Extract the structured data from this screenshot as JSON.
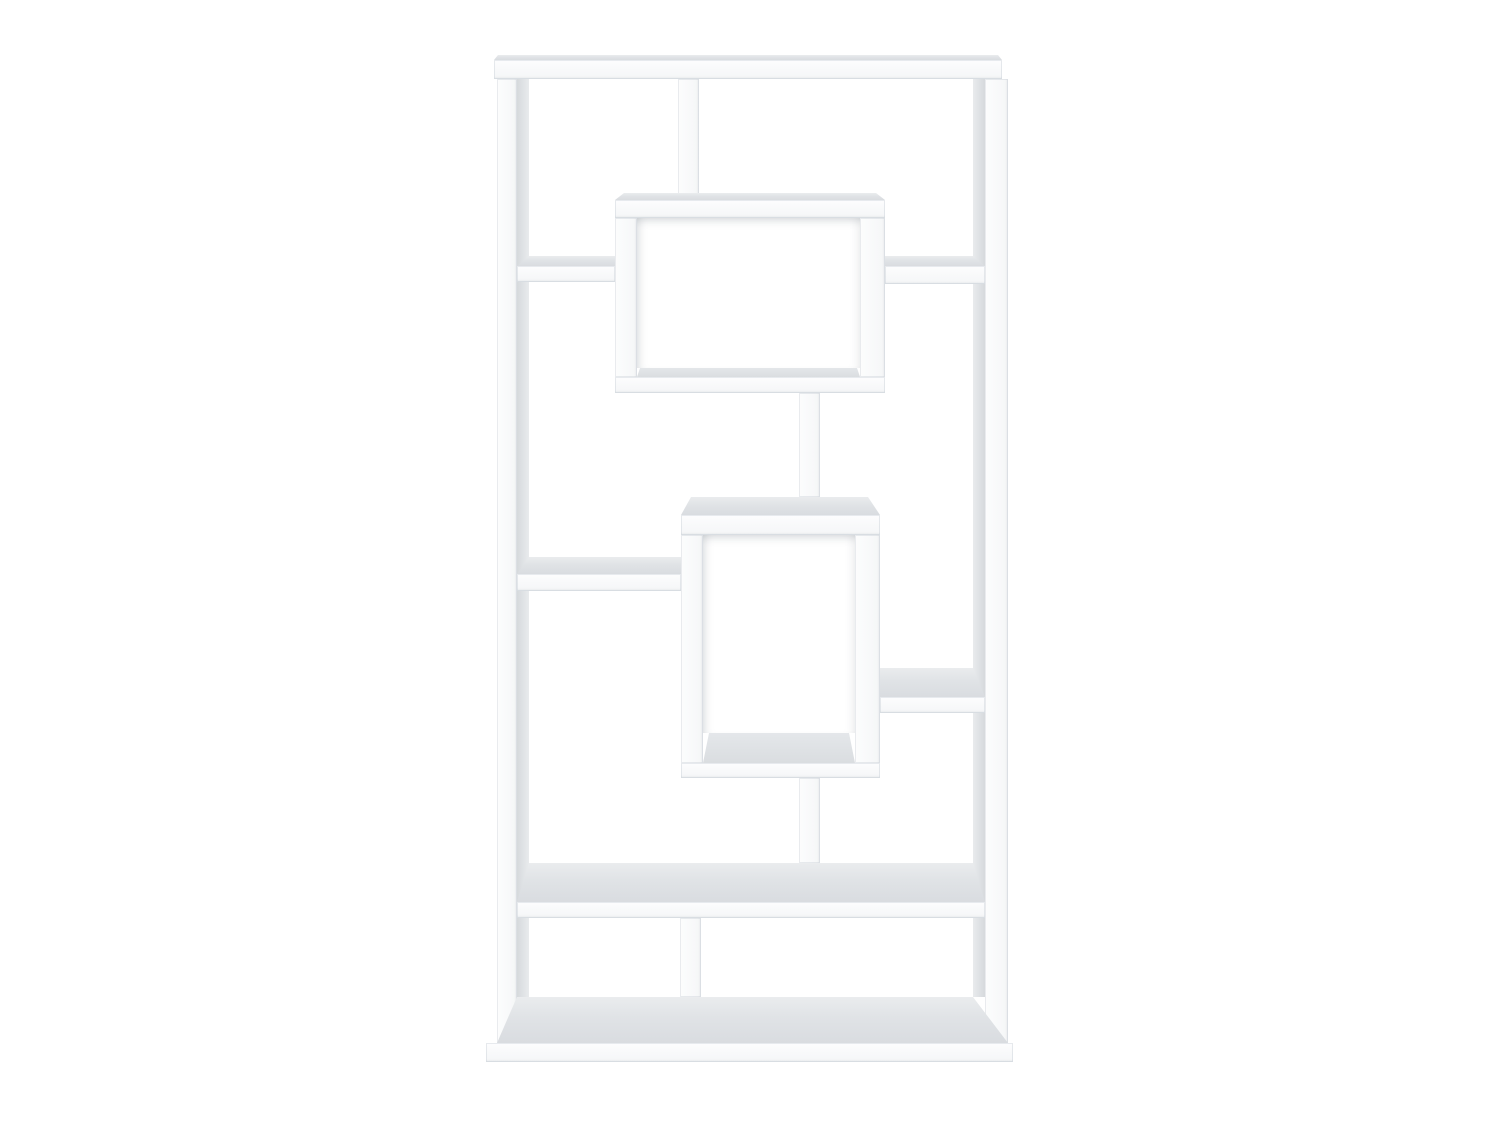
{
  "scene": {
    "description": "Product photo of a white geometric bookcase with ten asymmetric open shelf compartments on a plain white background",
    "background_color": "#ffffff",
    "canvas": {
      "width": 1500,
      "height": 1125
    },
    "palette": {
      "furniture_white": "#fafbfc",
      "edge_line": "#e4e7ea",
      "top_face_gray": "#dde0e3",
      "side_face_gray": "#d8dbde",
      "cavity_shadow": "#aab3bc"
    }
  },
  "boards": [
    {
      "name": "left-panel-inner-face",
      "face": "side-l",
      "x": 517,
      "y": 79,
      "w": 12,
      "h": 918
    },
    {
      "name": "right-panel-inner-face",
      "face": "side-r",
      "x": 973,
      "y": 79,
      "w": 12,
      "h": 918
    },
    {
      "name": "top-board-top-face",
      "face": "top",
      "x": 494,
      "y": 55,
      "w": 508,
      "h": 5,
      "clip": [
        [
          4,
          0
        ],
        [
          504,
          0
        ],
        [
          508,
          5
        ],
        [
          0,
          5
        ]
      ]
    },
    {
      "name": "top-board",
      "face": "front",
      "x": 494,
      "y": 60,
      "w": 508,
      "h": 19
    },
    {
      "name": "left-side-panel",
      "face": "front-v",
      "x": 497,
      "y": 79,
      "w": 20,
      "h": 964
    },
    {
      "name": "right-side-panel",
      "face": "front-v",
      "x": 985,
      "y": 79,
      "w": 23,
      "h": 964
    },
    {
      "name": "upper-divider",
      "face": "front-v",
      "x": 678,
      "y": 79,
      "w": 21,
      "h": 121
    },
    {
      "name": "upper-box-top-face",
      "face": "top",
      "x": 615,
      "y": 193,
      "w": 270,
      "h": 7,
      "clip": [
        [
          9,
          0
        ],
        [
          261,
          0
        ],
        [
          270,
          7
        ],
        [
          0,
          7
        ]
      ]
    },
    {
      "name": "upper-box-top",
      "face": "front",
      "x": 615,
      "y": 200,
      "w": 270,
      "h": 18
    },
    {
      "name": "upper-box-cavity",
      "face": "cavity",
      "x": 637,
      "y": 218,
      "w": 223,
      "h": 150
    },
    {
      "name": "upper-box-left-side",
      "face": "front-v",
      "x": 615,
      "y": 218,
      "w": 22,
      "h": 159
    },
    {
      "name": "upper-box-right-side",
      "face": "front-v",
      "x": 860,
      "y": 218,
      "w": 25,
      "h": 159
    },
    {
      "name": "upper-box-floor",
      "face": "floor",
      "x": 637,
      "y": 368,
      "w": 223,
      "h": 9,
      "clip": [
        [
          3,
          0
        ],
        [
          220,
          0
        ],
        [
          223,
          9
        ],
        [
          0,
          9
        ]
      ]
    },
    {
      "name": "upper-box-bottom",
      "face": "front",
      "x": 615,
      "y": 377,
      "w": 270,
      "h": 16
    },
    {
      "name": "upper-left-shelf-top-face",
      "face": "top",
      "x": 517,
      "y": 256,
      "w": 98,
      "h": 10,
      "clip": [
        [
          12,
          0
        ],
        [
          98,
          0
        ],
        [
          98,
          10
        ],
        [
          0,
          10
        ]
      ]
    },
    {
      "name": "upper-left-shelf",
      "face": "front",
      "x": 517,
      "y": 266,
      "w": 98,
      "h": 16
    },
    {
      "name": "upper-right-shelf-top-face",
      "face": "top",
      "x": 885,
      "y": 256,
      "w": 100,
      "h": 10,
      "clip": [
        [
          0,
          0
        ],
        [
          88,
          0
        ],
        [
          100,
          10
        ],
        [
          0,
          10
        ]
      ]
    },
    {
      "name": "upper-right-shelf",
      "face": "front",
      "x": 885,
      "y": 266,
      "w": 100,
      "h": 18
    },
    {
      "name": "upper-connector-post",
      "face": "front-v",
      "x": 799,
      "y": 393,
      "w": 21,
      "h": 104
    },
    {
      "name": "middle-box-top-face",
      "face": "top",
      "x": 681,
      "y": 497,
      "w": 199,
      "h": 18,
      "clip": [
        [
          10,
          0
        ],
        [
          187,
          0
        ],
        [
          199,
          18
        ],
        [
          0,
          18
        ]
      ]
    },
    {
      "name": "middle-box-top",
      "face": "front",
      "x": 681,
      "y": 515,
      "w": 199,
      "h": 20
    },
    {
      "name": "middle-box-cavity",
      "face": "cavity",
      "x": 703,
      "y": 535,
      "w": 152,
      "h": 198
    },
    {
      "name": "middle-box-left-side",
      "face": "front-v",
      "x": 681,
      "y": 535,
      "w": 22,
      "h": 228
    },
    {
      "name": "middle-box-right-side",
      "face": "front-v",
      "x": 855,
      "y": 535,
      "w": 25,
      "h": 228
    },
    {
      "name": "middle-box-floor",
      "face": "floor",
      "x": 703,
      "y": 733,
      "w": 152,
      "h": 30,
      "clip": [
        [
          6,
          0
        ],
        [
          146,
          0
        ],
        [
          152,
          30
        ],
        [
          0,
          30
        ]
      ]
    },
    {
      "name": "middle-box-bottom",
      "face": "front",
      "x": 681,
      "y": 763,
      "w": 199,
      "h": 15
    },
    {
      "name": "middle-left-shelf-top-face",
      "face": "top",
      "x": 517,
      "y": 557,
      "w": 164,
      "h": 17,
      "clip": [
        [
          12,
          0
        ],
        [
          164,
          0
        ],
        [
          164,
          17
        ],
        [
          0,
          17
        ]
      ]
    },
    {
      "name": "middle-left-shelf",
      "face": "front",
      "x": 517,
      "y": 574,
      "w": 164,
      "h": 17
    },
    {
      "name": "middle-right-shelf-top-face",
      "face": "top",
      "x": 880,
      "y": 668,
      "w": 105,
      "h": 29,
      "clip": [
        [
          0,
          0
        ],
        [
          93,
          0
        ],
        [
          105,
          29
        ],
        [
          0,
          29
        ]
      ]
    },
    {
      "name": "middle-right-shelf",
      "face": "front",
      "x": 880,
      "y": 697,
      "w": 105,
      "h": 16
    },
    {
      "name": "lower-connector-post",
      "face": "front-v",
      "x": 799,
      "y": 778,
      "w": 21,
      "h": 85
    },
    {
      "name": "lower-shelf-top-face",
      "face": "top",
      "x": 517,
      "y": 863,
      "w": 468,
      "h": 39,
      "clip": [
        [
          12,
          0
        ],
        [
          456,
          0
        ],
        [
          468,
          39
        ],
        [
          0,
          39
        ]
      ]
    },
    {
      "name": "lower-shelf",
      "face": "front",
      "x": 517,
      "y": 902,
      "w": 468,
      "h": 16
    },
    {
      "name": "lower-divider",
      "face": "front-v",
      "x": 680,
      "y": 918,
      "w": 21,
      "h": 79
    },
    {
      "name": "base-top-face",
      "face": "top",
      "x": 497,
      "y": 997,
      "w": 511,
      "h": 46,
      "clip": [
        [
          20,
          0
        ],
        [
          476,
          0
        ],
        [
          511,
          46
        ],
        [
          0,
          46
        ]
      ]
    },
    {
      "name": "base-board",
      "face": "front",
      "x": 486,
      "y": 1043,
      "w": 527,
      "h": 19
    }
  ]
}
